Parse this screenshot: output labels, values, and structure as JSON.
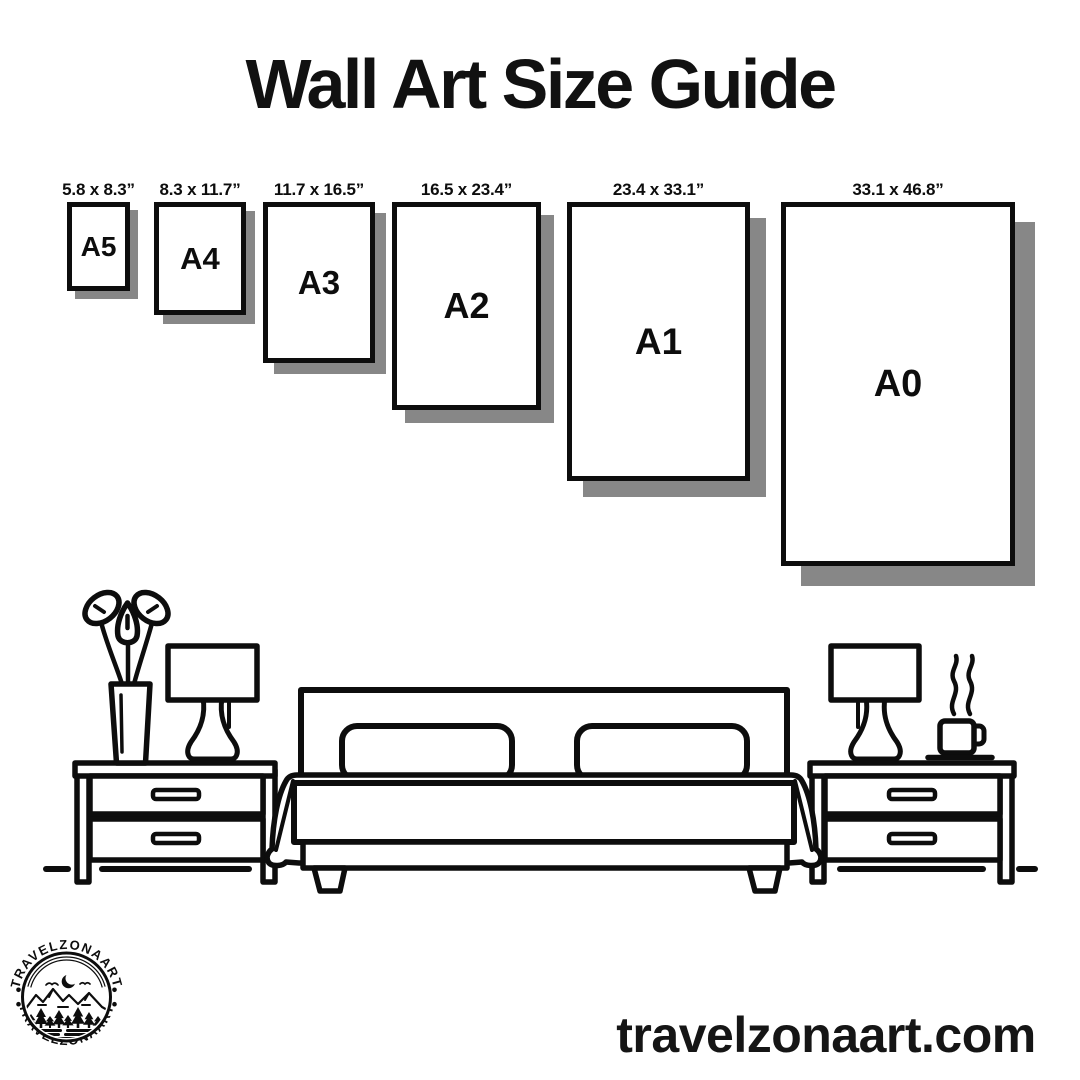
{
  "title": "Wall Art Size Guide",
  "website": "travelzonaart.com",
  "logo": {
    "brand_arc_top": "TRAVELZONAART",
    "brand_arc_bottom": "TRAVELZONAART"
  },
  "colors": {
    "ink": "#0d0d0d",
    "frame_shadow": "#878787",
    "background": "#ffffff"
  },
  "sizes": [
    {
      "code": "A5",
      "dimensions": "5.8 x 8.3”",
      "box": {
        "left": 67,
        "top": 202,
        "width": 63,
        "height": 89,
        "shadow": 8,
        "font": 28
      }
    },
    {
      "code": "A4",
      "dimensions": "8.3 x 11.7”",
      "box": {
        "left": 154,
        "top": 202,
        "width": 92,
        "height": 113,
        "shadow": 9,
        "font": 31
      }
    },
    {
      "code": "A3",
      "dimensions": "11.7 x 16.5”",
      "box": {
        "left": 263,
        "top": 202,
        "width": 112,
        "height": 161,
        "shadow": 11,
        "font": 33
      }
    },
    {
      "code": "A2",
      "dimensions": "16.5 x 23.4”",
      "box": {
        "left": 392,
        "top": 202,
        "width": 149,
        "height": 208,
        "shadow": 13,
        "font": 36
      }
    },
    {
      "code": "A1",
      "dimensions": "23.4 x 33.1”",
      "box": {
        "left": 567,
        "top": 202,
        "width": 183,
        "height": 279,
        "shadow": 16,
        "font": 37
      }
    },
    {
      "code": "A0",
      "dimensions": "33.1 x 46.8”",
      "box": {
        "left": 781,
        "top": 202,
        "width": 234,
        "height": 364,
        "shadow": 20,
        "font": 38
      }
    }
  ]
}
